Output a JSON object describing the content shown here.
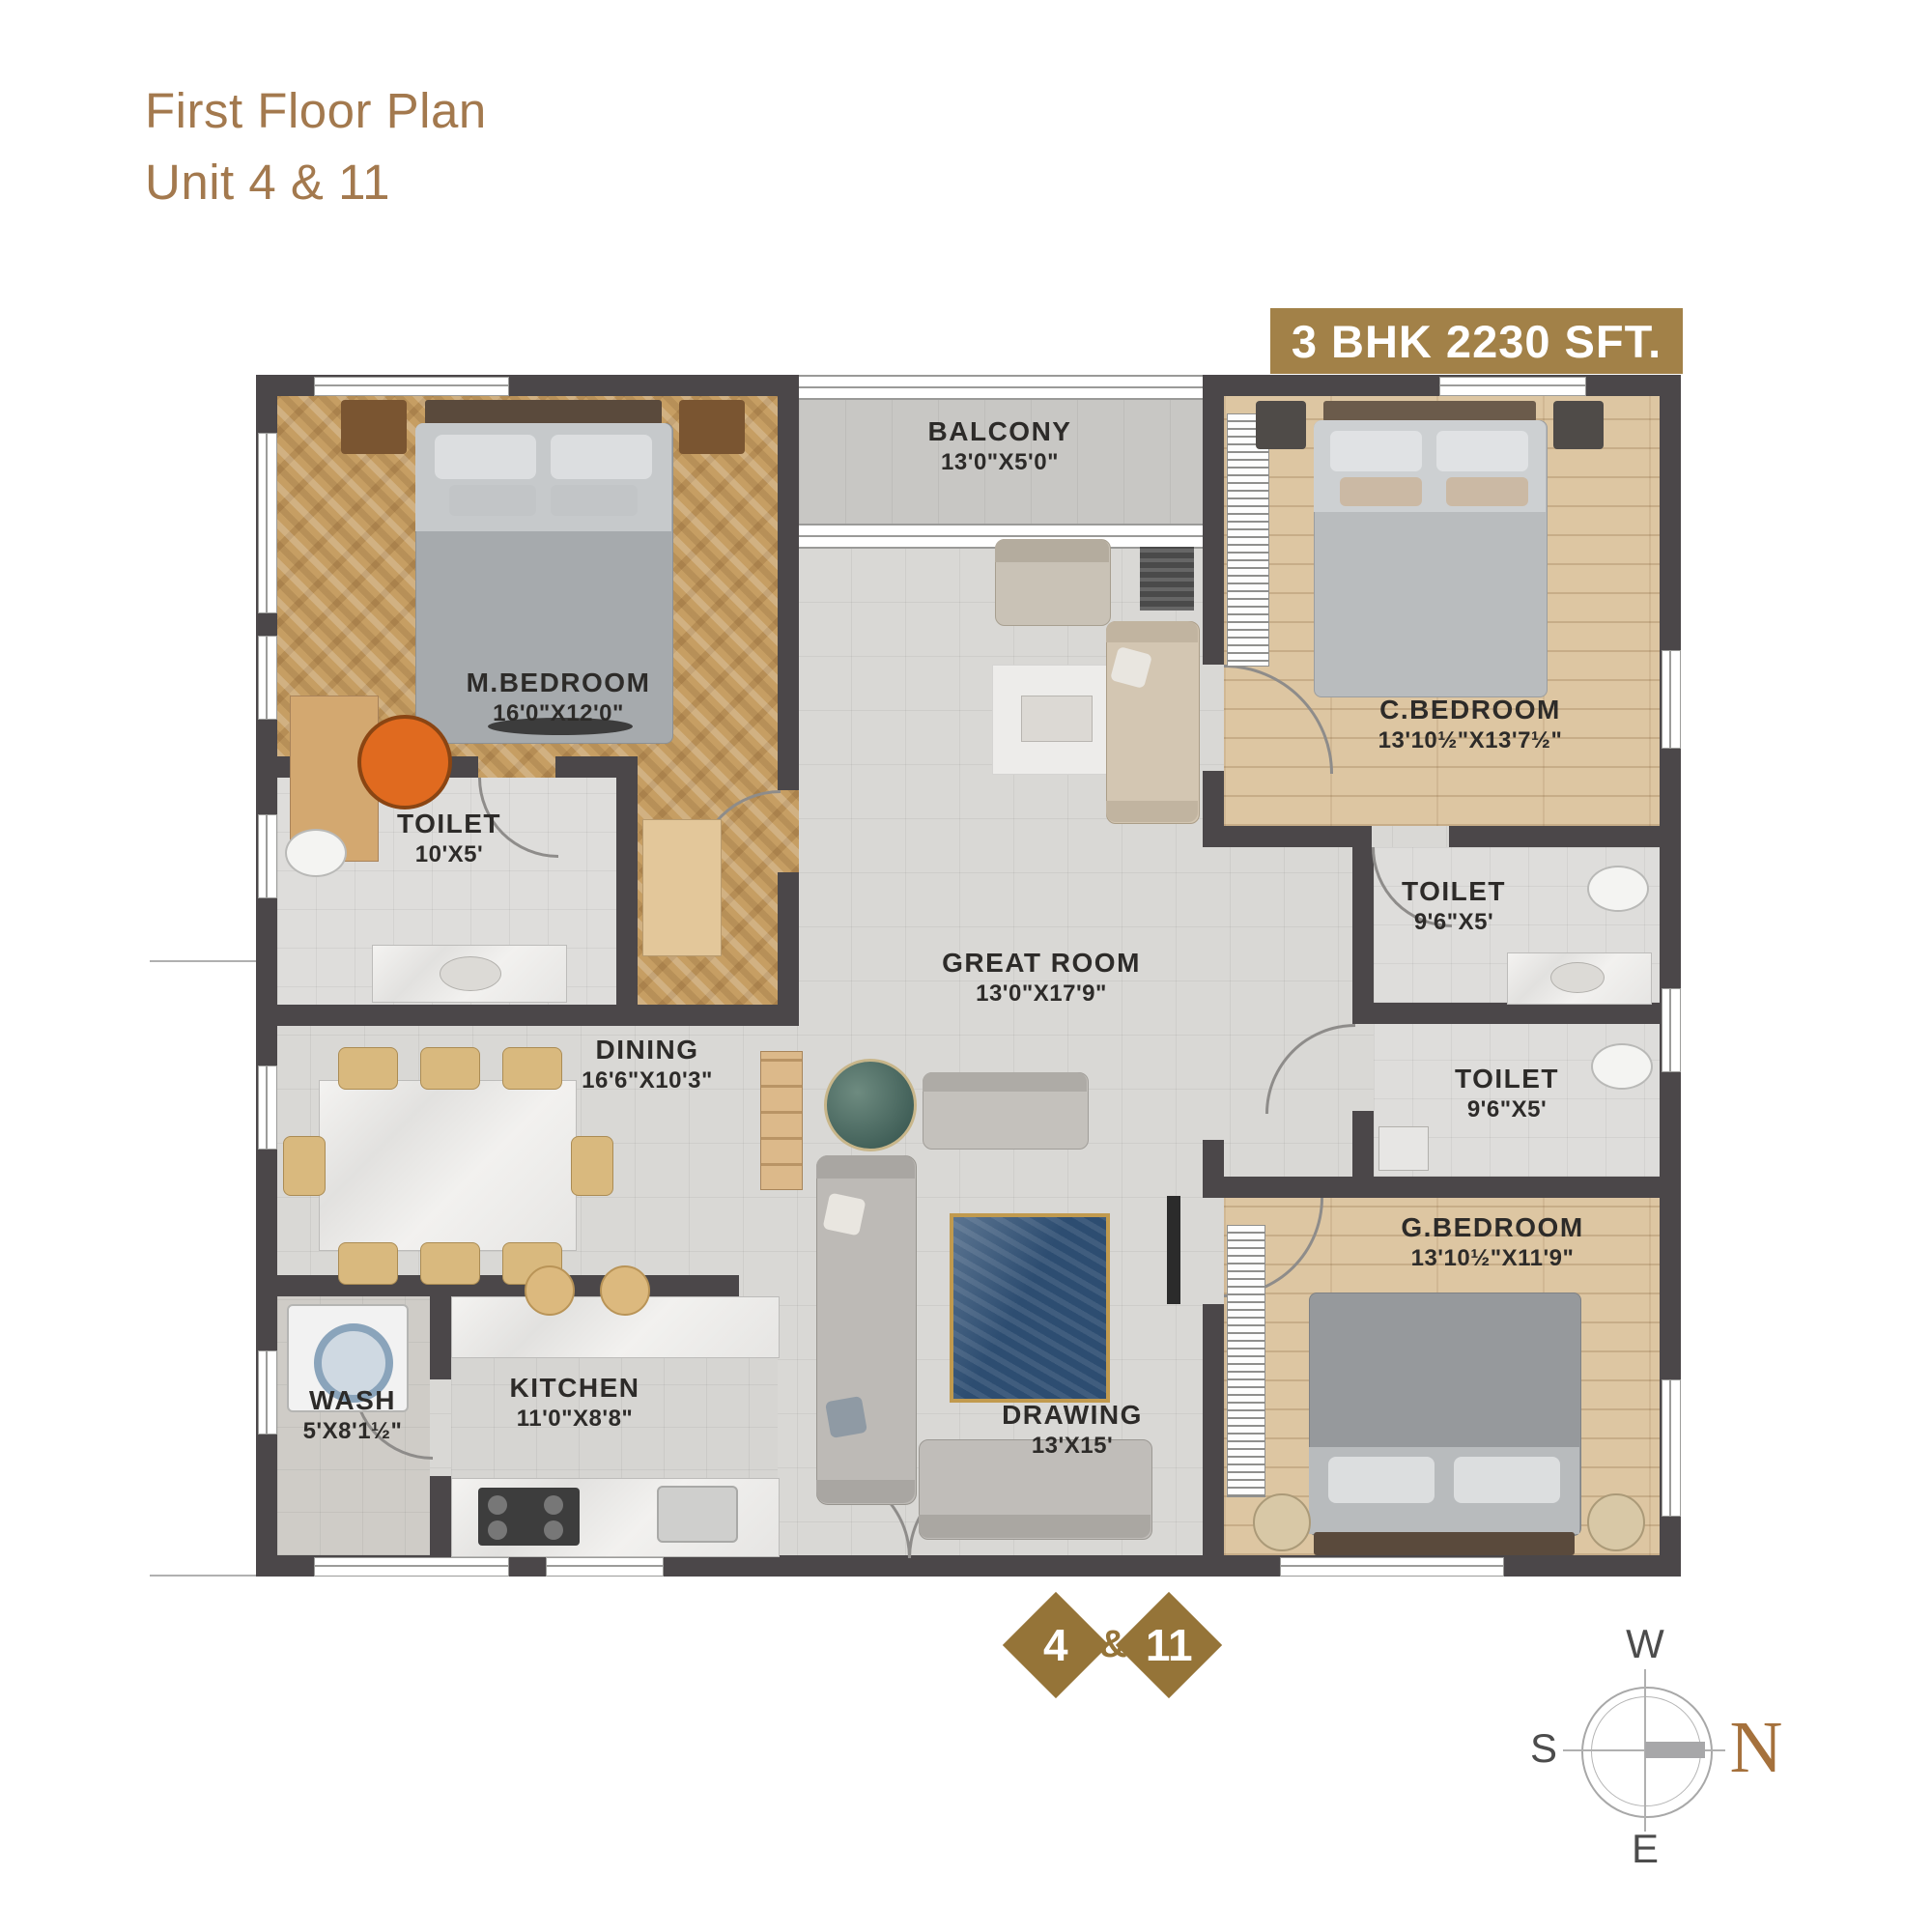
{
  "title": {
    "line1": "First Floor Plan",
    "line2": "Unit 4 & 11"
  },
  "badge": {
    "text": "3 BHK 2230 SFT."
  },
  "rooms": {
    "mbedroom": {
      "name": "M.BEDROOM",
      "dims": "16'0\"X12'0\""
    },
    "balcony": {
      "name": "BALCONY",
      "dims": "13'0\"X5'0\""
    },
    "cbedroom": {
      "name": "C.BEDROOM",
      "dims": "13'10½\"X13'7½\""
    },
    "toilet_m": {
      "name": "TOILET",
      "dims": "10'X5'"
    },
    "greatroom": {
      "name": "GREAT ROOM",
      "dims": "13'0\"X17'9\""
    },
    "toilet_c": {
      "name": "TOILET",
      "dims": "9'6\"X5'"
    },
    "toilet_g": {
      "name": "TOILET",
      "dims": "9'6\"X5'"
    },
    "dining": {
      "name": "DINING",
      "dims": "16'6\"X10'3\""
    },
    "gbedroom": {
      "name": "G.BEDROOM",
      "dims": "13'10½\"X11'9\""
    },
    "wash": {
      "name": "WASH",
      "dims": "5'X8'1½\""
    },
    "kitchen": {
      "name": "KITCHEN",
      "dims": "11'0\"X8'8\""
    },
    "drawing": {
      "name": "DRAWING",
      "dims": "13'X15'"
    }
  },
  "units": {
    "first": "4",
    "separator": "&",
    "second": "11"
  },
  "compass": {
    "west": "W",
    "south": "S",
    "east": "E",
    "north": "N"
  },
  "colors": {
    "accent_brown": "#a3794e",
    "badge_bg": "#a28148",
    "wall": "#4b4749",
    "diamond": "#957438",
    "rug_blue": "#2d4d71",
    "rug_border": "#c19a4e"
  }
}
